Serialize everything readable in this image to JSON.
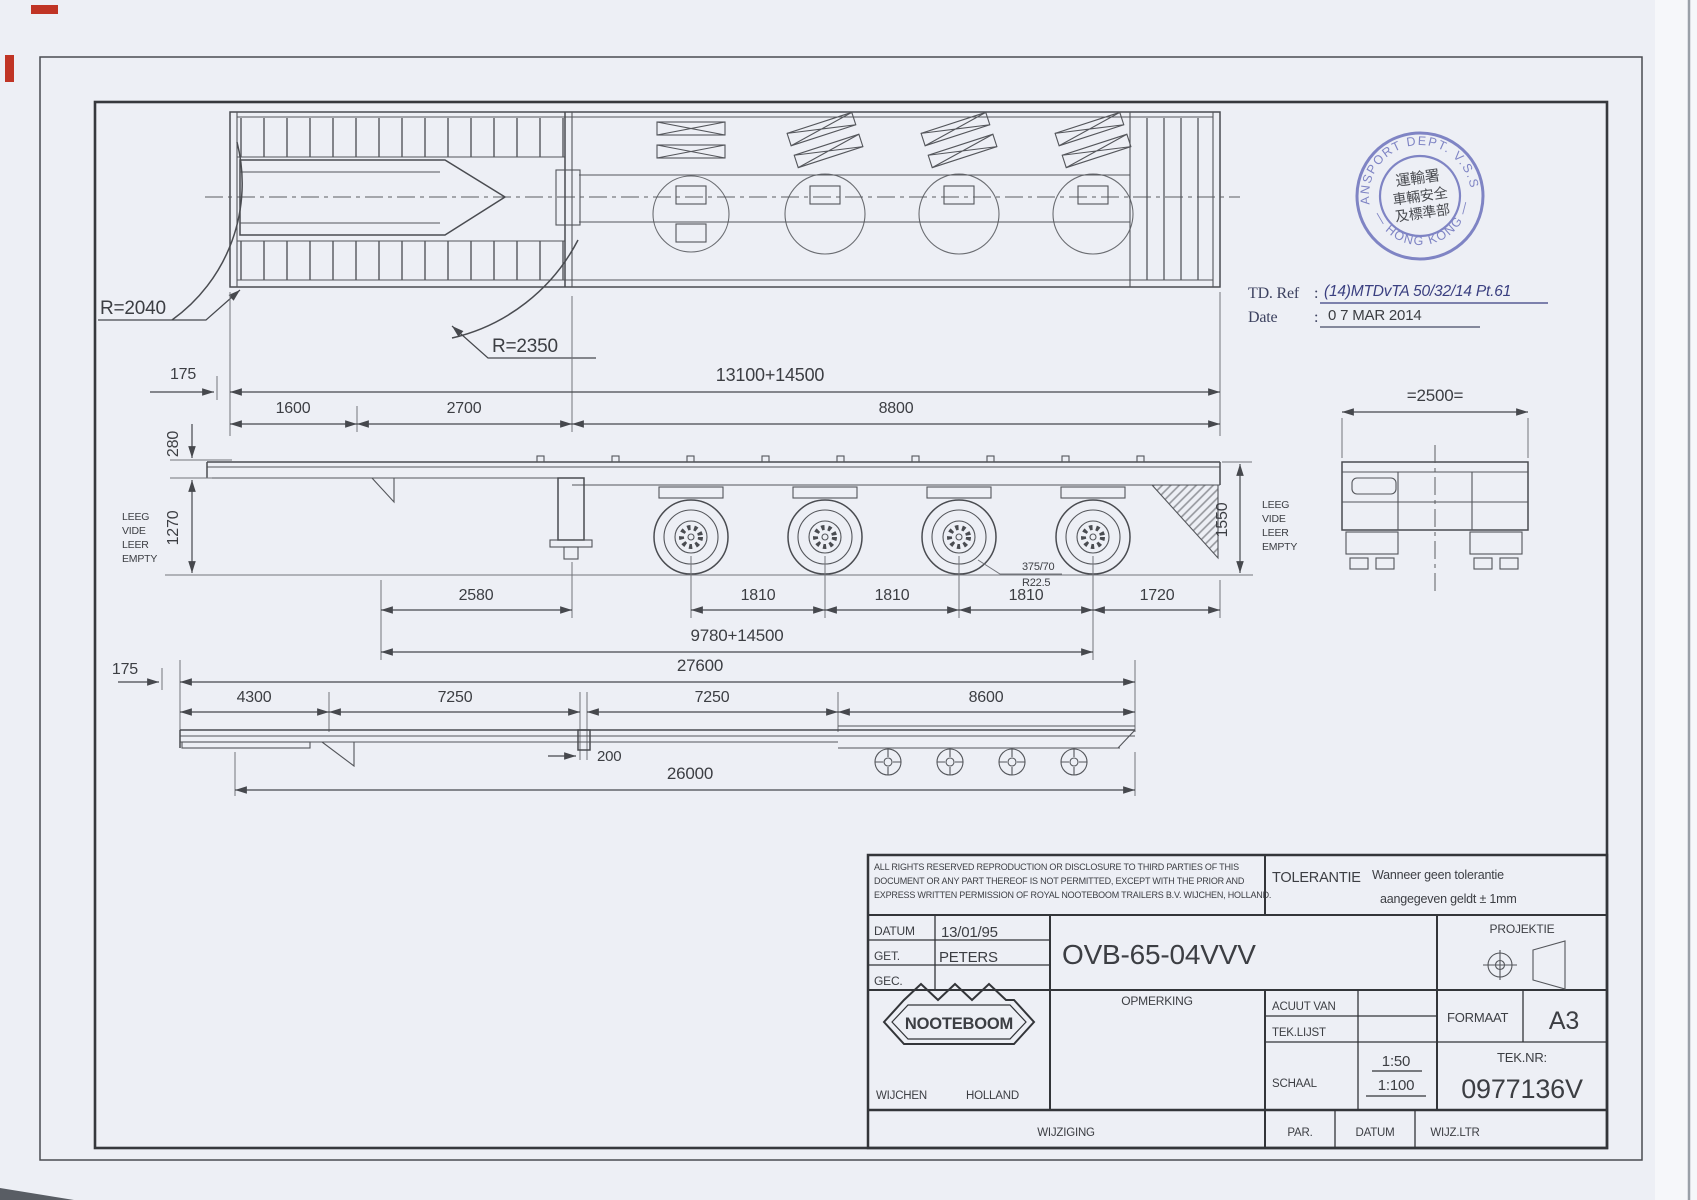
{
  "stamp": {
    "color": "#767cc0",
    "arc_top": "TRANSPORT DEPT. V.S.S.D.",
    "arc_bottom": "— HONG KONG —",
    "cjk_line1": "運輸署",
    "cjk_line2": "車輛安全",
    "cjk_line3": "及標準部"
  },
  "ref_block": {
    "ref_label": "TD. Ref",
    "colon": ":",
    "ref_value": "(14)MTDvTA 50/32/14 Pt.61",
    "date_label": "Date",
    "date_value": "0 7 MAR 2014"
  },
  "labels": {
    "d175": "175",
    "overall_top": "13100+14500",
    "d1600": "1600",
    "d2700": "2700",
    "d8800": "8800",
    "r2040": "R=2040",
    "r2350": "R=2350",
    "d280": "280",
    "d1270": "1270",
    "d1550": "1550",
    "empty": [
      "LEEG",
      "VIDE",
      "LEER",
      "EMPTY"
    ],
    "d2500": "=2500=",
    "d2580": "2580",
    "d1810": "1810",
    "d1720": "1720",
    "tire1": "375/70",
    "tire2": "R22.5",
    "wheelbase": "9780+14500",
    "d27600": "27600",
    "d4300": "4300",
    "d7250": "7250",
    "d8600": "8600",
    "d200": "200",
    "d26000": "26000"
  },
  "title_block": {
    "copyright1": "ALL RIGHTS RESERVED REPRODUCTION OR DISCLOSURE TO THIRD PARTIES OF THIS",
    "copyright2": "DOCUMENT OR ANY PART THEREOF IS NOT PERMITTED, EXCEPT WITH THE PRIOR AND",
    "copyright3": "EXPRESS WRITTEN PERMISSION OF ROYAL NOOTEBOOM TRAILERS B.V. WIJCHEN, HOLLAND.",
    "tolerantie_label": "TOLERANTIE",
    "tolerantie1": "Wanneer geen tolerantie",
    "tolerantie2": "aangegeven geldt ± 1mm",
    "datum_label": "DATUM",
    "datum_value": "13/01/95",
    "get_label": "GET.",
    "get_value": "PETERS",
    "gec_label": "GEC.",
    "gec_value": "",
    "drawing_number": "OVB-65-04VVV",
    "opmerking_label": "OPMERKING",
    "acuut_label": "ACUUT VAN",
    "teklijst_label": "TEK.LIJST",
    "schaal_label": "SCHAAL",
    "schaal_value1": "1:50",
    "schaal_value2": "1:100",
    "projektie_label": "PROJEKTIE",
    "formaat_label": "FORMAAT",
    "formaat_value": "A3",
    "teknr_label": "TEK.NR:",
    "teknr_value": "0977136V",
    "logo_text": "NOOTEBOOM",
    "logo_city": "WIJCHEN",
    "logo_country": "HOLLAND",
    "wijziging_label": "WIJZIGING",
    "par_label": "PAR.",
    "datum2_label": "DATUM",
    "wijzltr_label": "WIJZ.LTR"
  }
}
